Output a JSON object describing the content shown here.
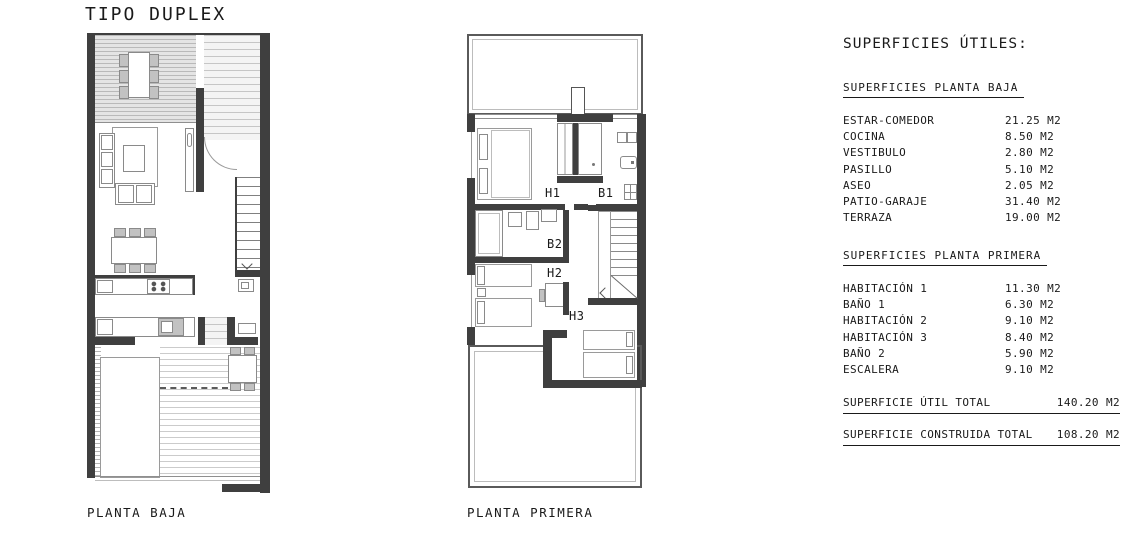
{
  "title": "TIPO DUPLEX",
  "plans": {
    "baja": {
      "label": "PLANTA BAJA"
    },
    "primera": {
      "label": "PLANTA PRIMERA",
      "rooms": {
        "h1": "H1",
        "b1": "B1",
        "b2": "B2",
        "h2": "H2",
        "h3": "H3"
      }
    }
  },
  "areas": {
    "title": "SUPERFICIES ÚTILES:",
    "sections": [
      {
        "heading": "SUPERFICIES PLANTA BAJA",
        "rows": [
          {
            "label": "ESTAR-COMEDOR",
            "value": "21.25 M2"
          },
          {
            "label": "COCINA",
            "value": "8.50 M2"
          },
          {
            "label": "VESTIBULO",
            "value": "2.80 M2"
          },
          {
            "label": "PASILLO",
            "value": "5.10 M2"
          },
          {
            "label": "ASEO",
            "value": "2.05 M2"
          },
          {
            "label": "PATIO-GARAJE",
            "value": "31.40 M2"
          },
          {
            "label": "TERRAZA",
            "value": "19.00 M2"
          }
        ]
      },
      {
        "heading": "SUPERFICIES PLANTA PRIMERA",
        "rows": [
          {
            "label": "HABITACIÓN 1",
            "value": "11.30 M2"
          },
          {
            "label": "BAÑO 1",
            "value": "6.30 M2"
          },
          {
            "label": "HABITACIÓN 2",
            "value": "9.10 M2"
          },
          {
            "label": "HABITACIÓN 3",
            "value": "8.40 M2"
          },
          {
            "label": "BAÑO 2",
            "value": "5.90 M2"
          },
          {
            "label": "ESCALERA",
            "value": "9.10 M2"
          }
        ]
      }
    ],
    "totals": [
      {
        "label": "SUPERFICIE ÚTIL TOTAL",
        "value": "140.20 M2"
      },
      {
        "label": "SUPERFICIE CONSTRUIDA TOTAL",
        "value": "108.20 M2"
      }
    ]
  },
  "colors": {
    "wall": "#3f3f3f",
    "thin_line": "#8f8f8f",
    "text": "#1a1a1a"
  }
}
